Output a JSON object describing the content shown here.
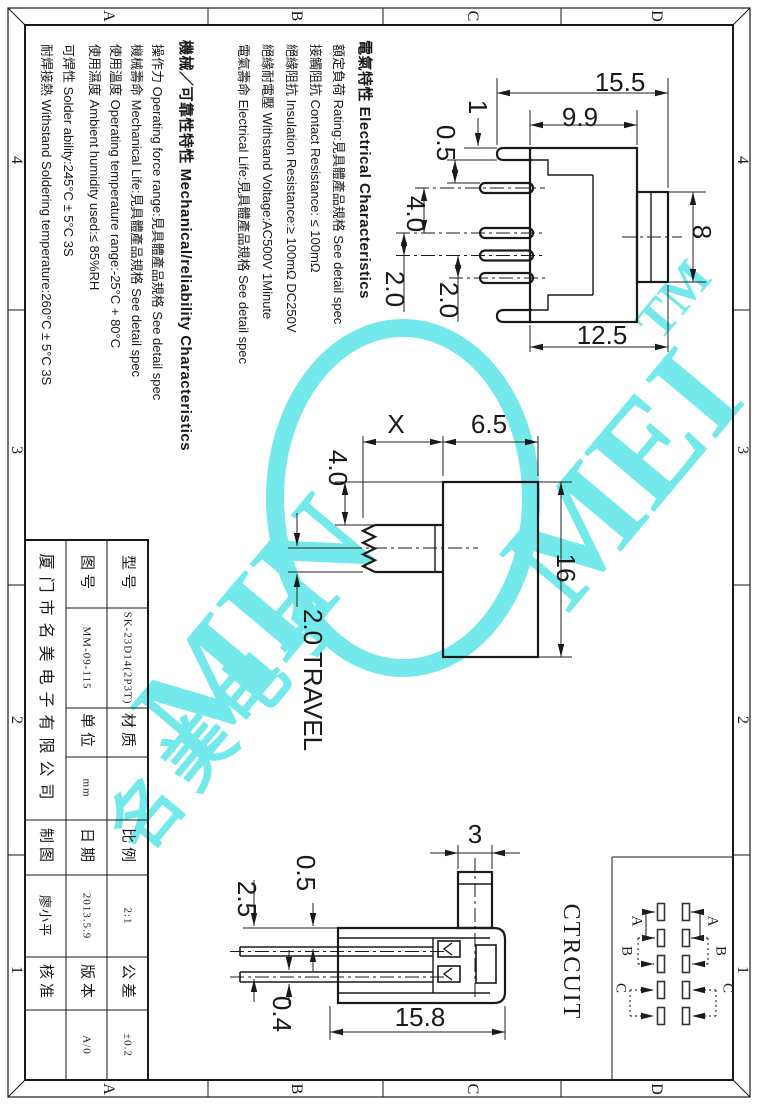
{
  "border": {
    "cols": [
      "A",
      "B",
      "C",
      "D"
    ],
    "rows": [
      "4",
      "3",
      "2",
      "1"
    ]
  },
  "notes": {
    "electrical": {
      "title": "電氣特性 Electrical Characteristics",
      "items": [
        "額定負荷 Rating:見具體產品規格 See detail spec",
        "接觸阻抗 Contact Resistance: ≤ 100mΩ",
        "絕緣阻抗 Insulation Resistance:≥ 100mΩ DC250V",
        "絕緣耐電壓 Withstand Voltage:AC500V 1Minute",
        "電氣壽命 Electrical Life:見具體產品規格 See detail spec"
      ]
    },
    "mechanical": {
      "title": "機械／可靠性特性 Mechanical/reliability Characteristics",
      "items": [
        "操作力 Operating force range:見具體產品規格 See detail spec",
        "機械壽命 Mechanical Life:見具體產品規格 See detail spec",
        "使用溫度 Operating temperature range:-25°C + 80°C",
        "使用濕度 Ambient humidity used:≤ 85%RH",
        "可焊性 Solder ability:245°C ± 5°C  3S",
        "耐焊接熱 Withstand Soldering temperature:260°C ± 5°C  3S"
      ]
    }
  },
  "title_block": {
    "company": "厦门市名美电子有限公司",
    "labels": {
      "model": "型号",
      "drawing_no": "图号",
      "material": "材质",
      "unit": "单位",
      "scale": "比例",
      "date": "日期",
      "tolerance": "公差",
      "version": "版本",
      "drafter": "制图",
      "approver": "核准"
    },
    "values": {
      "model": "SK-23D14(2P3T)",
      "drawing_no": "MM-09-115",
      "material": "",
      "unit": "mm",
      "scale": "2:1",
      "date": "2013.5.9",
      "tolerance": "±0.2",
      "version": "A/0",
      "drafter": "廖小平",
      "approver": ""
    }
  },
  "views": {
    "side": {
      "w155": "15.5",
      "w99": "9.9",
      "t1": "1",
      "g05": "0.5",
      "p40": "4.0",
      "p20a": "2.0",
      "p20b": "2.0",
      "h8": "8",
      "w125": "12.5"
    },
    "front": {
      "x": "X",
      "d65": "6.5",
      "d40": "4.0",
      "h16": "16",
      "travel": "2.0 TRAVEL"
    },
    "top": {
      "w3": "3",
      "g05": "0.5",
      "g25": "2.5",
      "t04": "0.4",
      "w158": "15.8"
    }
  },
  "circuit": {
    "title": "CTRCUIT",
    "pos_a": "A",
    "pos_b": "B",
    "pos_c": "C"
  },
  "watermark": {
    "part1": "MIN",
    "part2": "MEI",
    "tm": "TM",
    "cn": "名美电子",
    "color": "#74e9ec"
  }
}
